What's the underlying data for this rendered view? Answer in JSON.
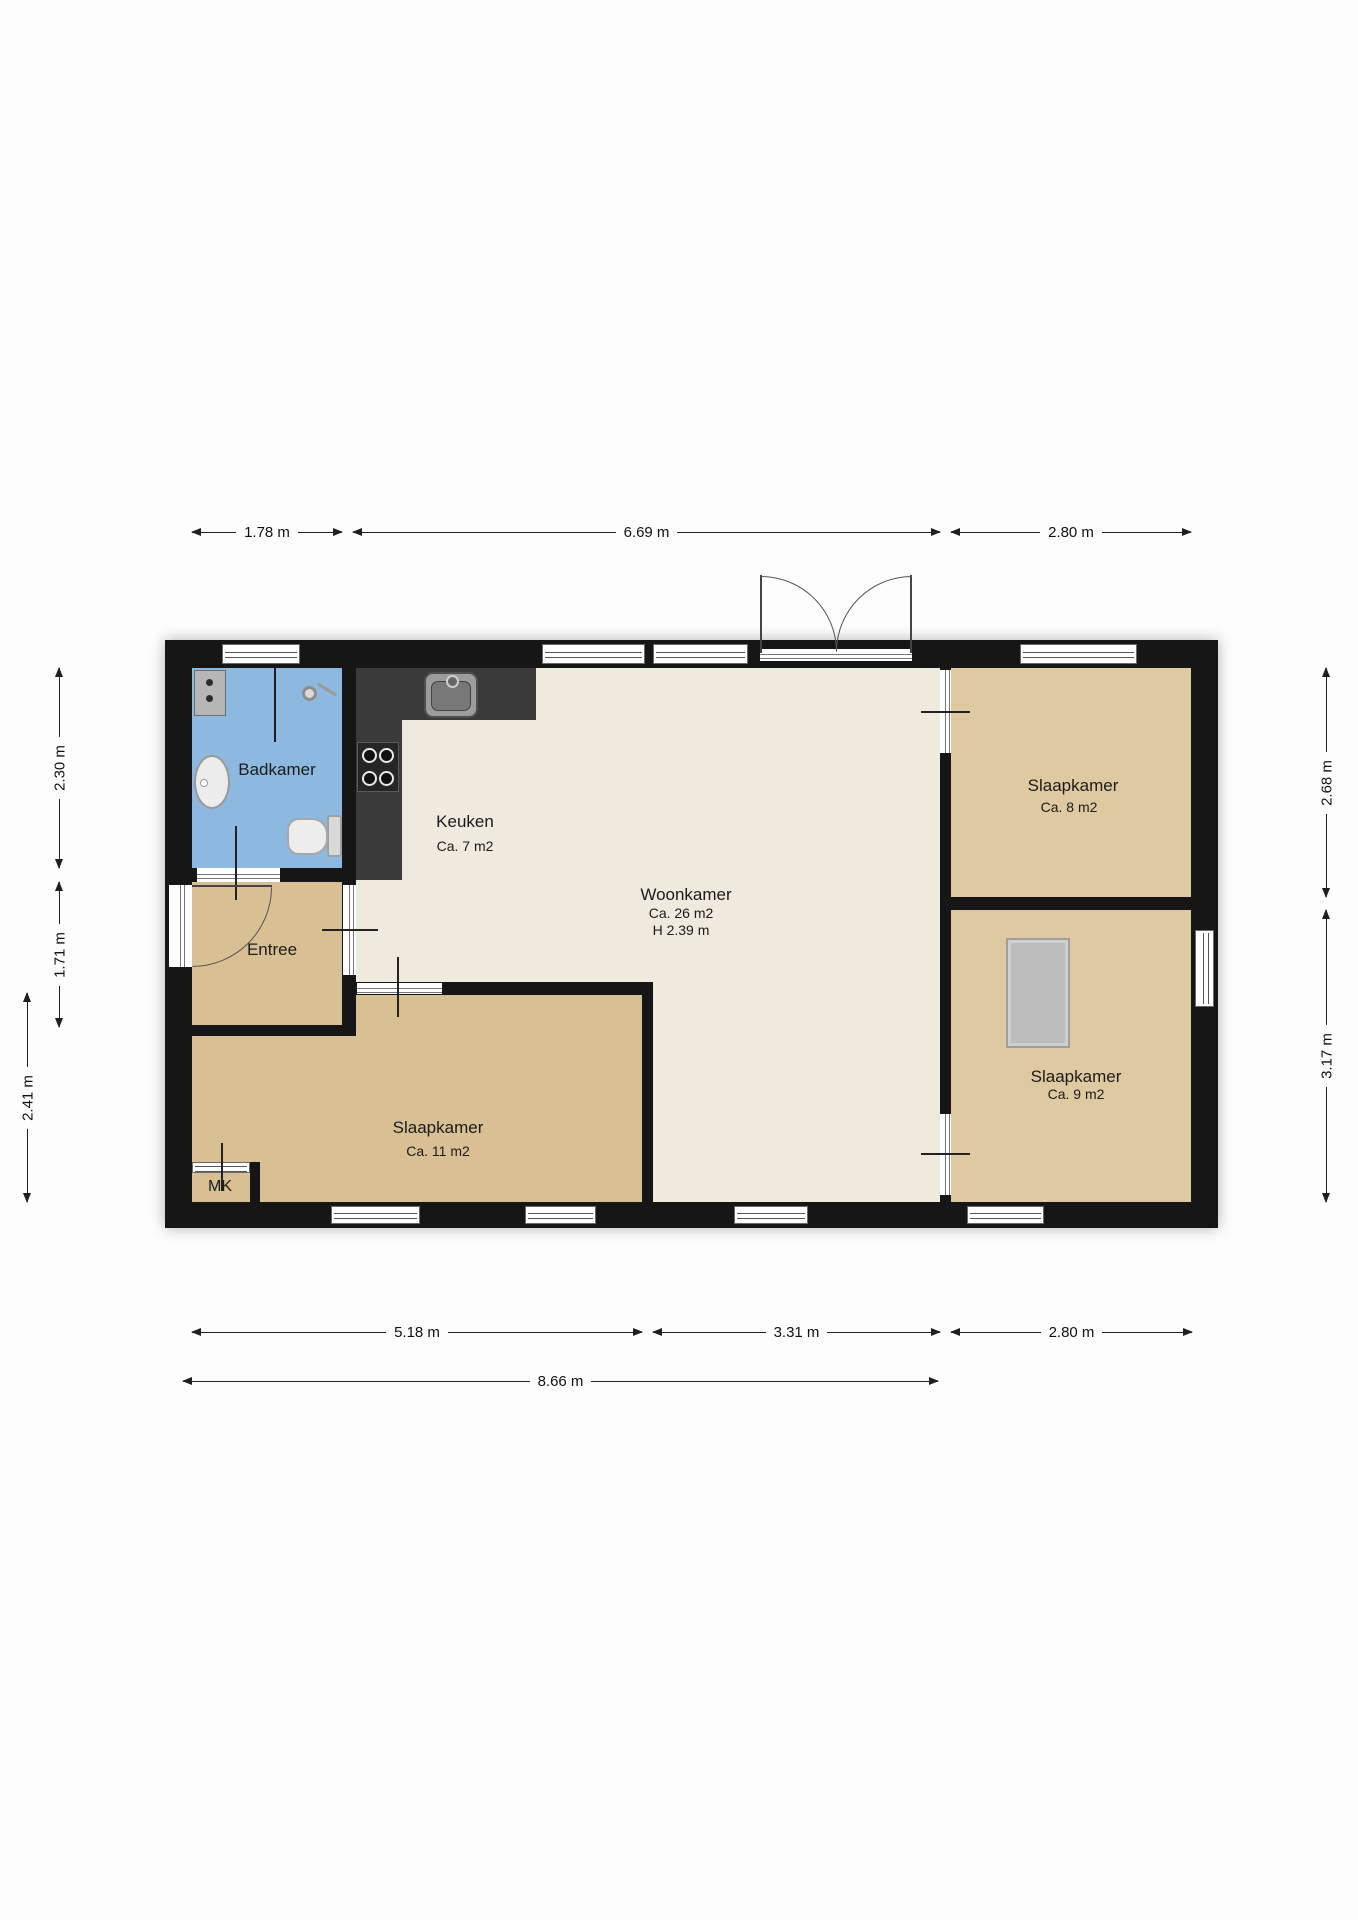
{
  "rooms": {
    "badkamer": {
      "name": "Badkamer"
    },
    "keuken": {
      "name": "Keuken",
      "area": "Ca. 7 m2"
    },
    "woonkamer": {
      "name": "Woonkamer",
      "area": "Ca. 26 m2",
      "ceiling_height": "H 2.39 m"
    },
    "entree": {
      "name": "Entree"
    },
    "slaapkamer_left": {
      "name": "Slaapkamer",
      "area": "Ca. 11 m2"
    },
    "slaapkamer_top_right": {
      "name": "Slaapkamer",
      "area": "Ca. 8 m2"
    },
    "slaapkamer_bottom_right": {
      "name": "Slaapkamer",
      "area": "Ca. 9 m2"
    },
    "meterkast": {
      "name": "MK"
    }
  },
  "dimensions": {
    "top": [
      "1.78 m",
      "6.69 m",
      "2.80 m"
    ],
    "left": [
      "2.30 m",
      "1.71 m",
      "2.41 m"
    ],
    "right": [
      "2.68 m",
      "3.17 m"
    ],
    "bottom": [
      "5.18 m",
      "3.31 m",
      "2.80 m"
    ],
    "bottom_total": "8.66 m"
  },
  "colors": {
    "wall": "#161616",
    "bathroom": "#8db8e0",
    "living": "#f0e9dd",
    "bedroom": "#d8bf94",
    "bedroom_right": "#dec9a0",
    "counter": "#3a3a3a"
  }
}
